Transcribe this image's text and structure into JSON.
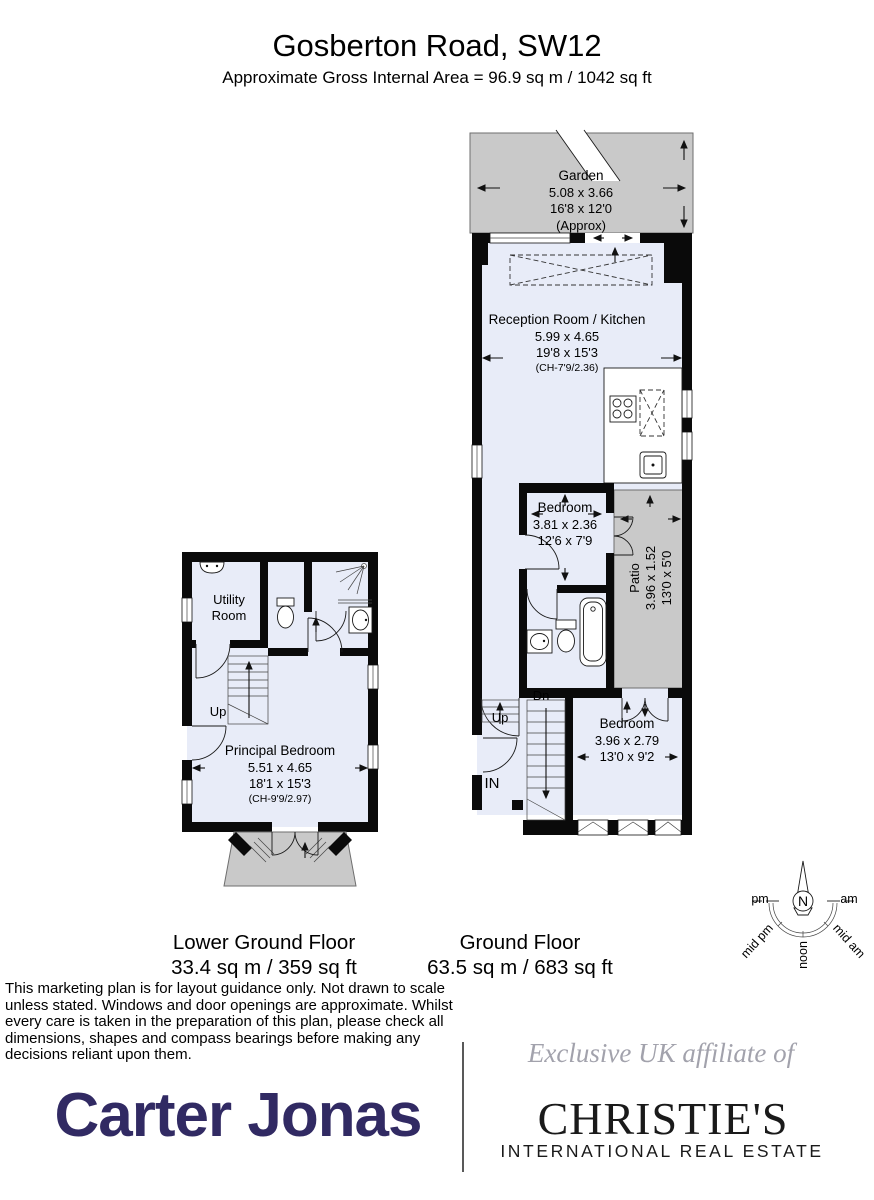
{
  "header": {
    "title": "Gosberton Road, SW12",
    "subtitle": "Approximate Gross Internal Area = 96.9 sq m / 1042 sq ft"
  },
  "ground_floor": {
    "label": "Ground Floor",
    "area": "63.5 sq m / 683 sq ft",
    "garden": {
      "name": "Garden",
      "dims_m": "5.08 x 3.66",
      "dims_ft": "16'8 x 12'0",
      "note": "(Approx)"
    },
    "reception": {
      "name": "Reception Room / Kitchen",
      "dims_m": "5.99 x 4.65",
      "dims_ft": "19'8 x 15'3",
      "ceiling_height": "(CH-7'9/2.36)"
    },
    "bedroom_middle": {
      "name": "Bedroom",
      "dims_m": "3.81 x 2.36",
      "dims_ft": "12'6 x 7'9"
    },
    "patio": {
      "name": "Patio",
      "dims_m": "3.96 x 1.52",
      "dims_ft": "13'0 x 5'0"
    },
    "bedroom_front": {
      "name": "Bedroom",
      "dims_m": "3.96 x 2.79",
      "dims_ft": "13'0 x 9'2"
    },
    "stairs_down_label": "Dn",
    "stairs_up_label": "Up",
    "entrance_label": "IN"
  },
  "lower_ground_floor": {
    "label": "Lower Ground Floor",
    "area": "33.4 sq m / 359 sq ft",
    "utility": {
      "name": "Utility Room"
    },
    "principal_bedroom": {
      "name": "Principal Bedroom",
      "dims_m": "5.51 x 4.65",
      "dims_ft": "18'1 x 15'3",
      "ceiling_height": "(CH-9'9/2.97)"
    },
    "stairs_up_label": "Up"
  },
  "compass": {
    "north": "N",
    "pm": "pm",
    "am": "am",
    "mid_pm": "mid pm",
    "noon": "noon",
    "mid_am": "mid am"
  },
  "disclaimer": "This marketing plan is for layout guidance only. Not drawn to scale unless stated. Windows and door openings are approximate. Whilst every care is taken in the preparation of this plan, please check all dimensions, shapes and compass bearings before making any decisions reliant upon them.",
  "footer": {
    "affiliate_text": "Exclusive UK affiliate of",
    "brand_primary": "Carter Jonas",
    "brand_secondary": "CHRISTIE'S",
    "brand_secondary_sub": "INTERNATIONAL REAL ESTATE"
  },
  "colors": {
    "wall": "#0a0a0a",
    "room_fill": "#e8ecf8",
    "outdoor_fill": "#c9c9c9",
    "brand_navy": "#312a63"
  }
}
